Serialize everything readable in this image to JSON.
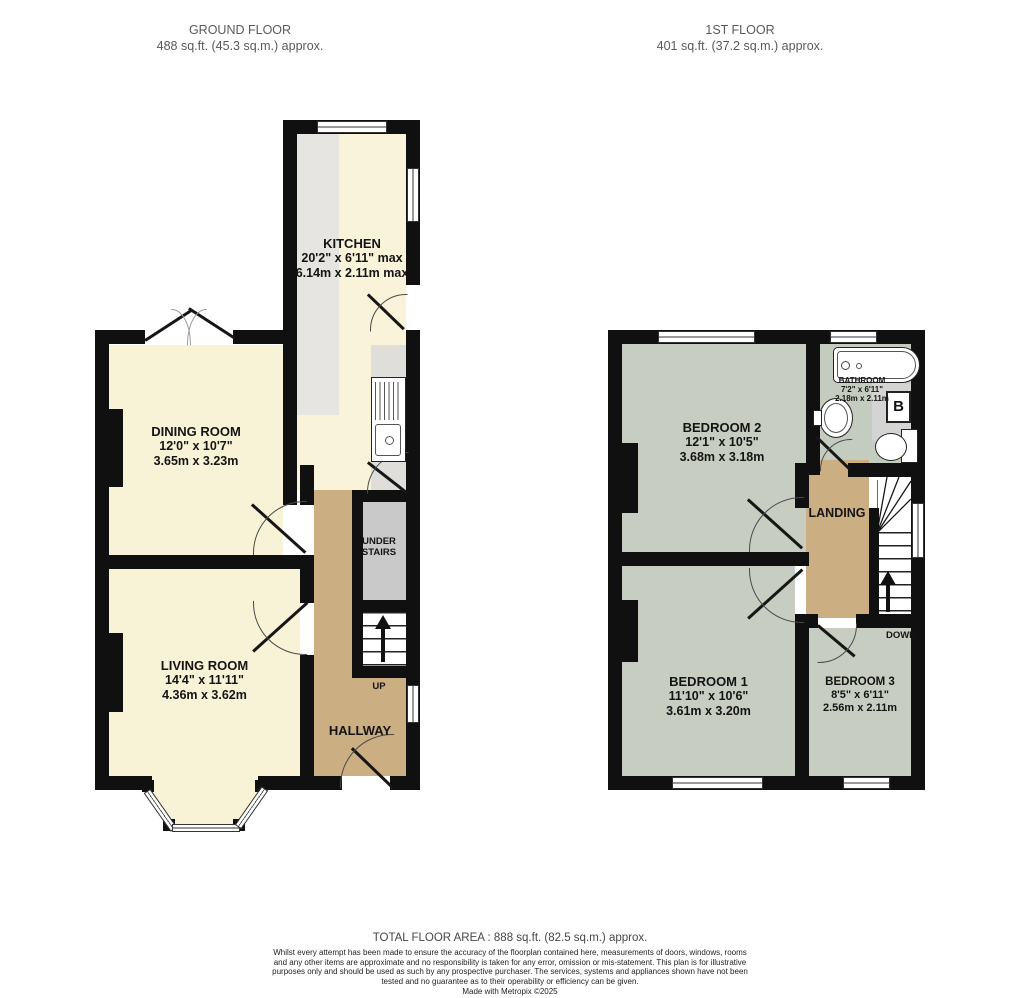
{
  "headers": {
    "ground": {
      "title": "GROUND FLOOR",
      "area": "488 sq.ft. (45.3 sq.m.) approx."
    },
    "first": {
      "title": "1ST FLOOR",
      "area": "401 sq.ft. (37.2 sq.m.) approx."
    }
  },
  "ground_floor": {
    "kitchen": {
      "name": "KITCHEN",
      "imperial": "20'2\" x 6'11\" max",
      "metric": "6.14m x 2.11m max"
    },
    "dining_room": {
      "name": "DINING ROOM",
      "imperial": "12'0\" x 10'7\"",
      "metric": "3.65m x 3.23m"
    },
    "living_room": {
      "name": "LIVING ROOM",
      "imperial": "14'4\" x 11'11\"",
      "metric": "4.36m x 3.62m"
    },
    "hallway": {
      "name": "HALLWAY"
    },
    "under_stairs": {
      "line1": "UNDER",
      "line2": "STAIRS"
    },
    "stairs": {
      "label": "UP"
    }
  },
  "first_floor": {
    "bedroom2": {
      "name": "BEDROOM 2",
      "imperial": "12'1\" x 10'5\"",
      "metric": "3.68m x 3.18m"
    },
    "bathroom": {
      "name": "BATHROOM",
      "imperial": "7'2\" x 6'11\"",
      "metric": "2.18m x 2.11m"
    },
    "landing": {
      "name": "LANDING"
    },
    "bedroom1": {
      "name": "BEDROOM 1",
      "imperial": "11'10\" x 10'6\"",
      "metric": "3.61m x 3.20m"
    },
    "bedroom3": {
      "name": "BEDROOM 3",
      "imperial": "8'5\" x 6'11\"",
      "metric": "2.56m x 2.11m"
    },
    "stairs": {
      "label": "DOWN"
    },
    "boiler": {
      "label": "B"
    }
  },
  "footer": {
    "total_area": "TOTAL FLOOR AREA : 888 sq.ft. (82.5 sq.m.) approx.",
    "disclaimer": "Whilst every attempt has been made to ensure the accuracy of the floorplan contained here, measurements of doors, windows, rooms and any other items are approximate and no responsibility is taken for any error, omission or mis-statement. This plan is for illustrative purposes only and should be used as such by any prospective purchaser. The services, systems and appliances shown have not been tested and no guarantee as to their operability or efficiency can be given.",
    "credit": "Made with Metropix ©2025"
  },
  "colors": {
    "wall": "#101010",
    "room_cream": "#f8f3d9",
    "room_tan": "#ccae83",
    "room_sage": "#c7cdc1",
    "counter_gray": "#e6e5e1",
    "understairs_gray": "#c9c9c9",
    "header_text": "#5a5a5a",
    "label_text": "#141414"
  }
}
